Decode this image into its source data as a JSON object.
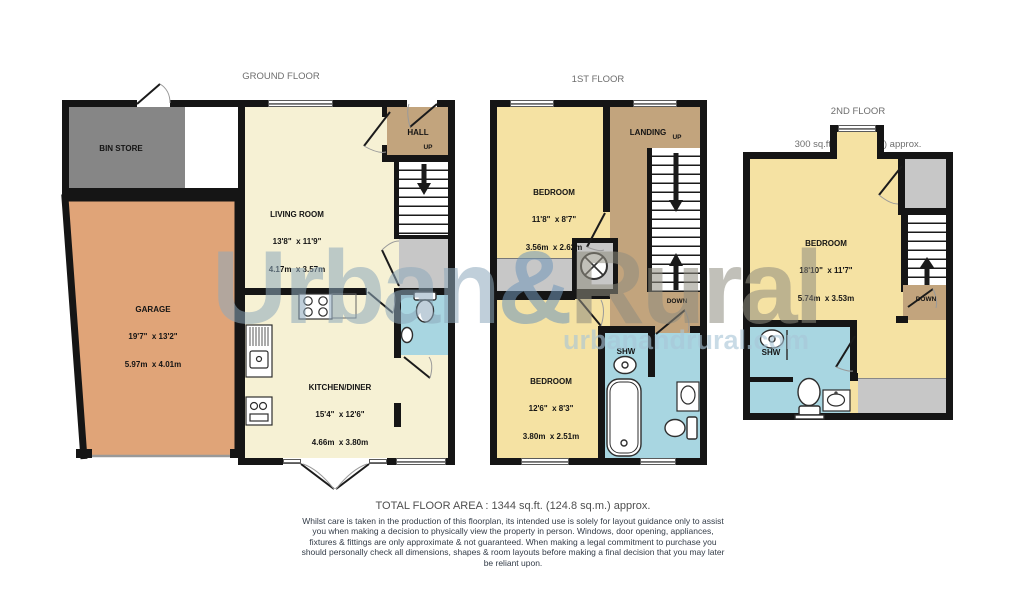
{
  "watermark": {
    "brand_urban": "Urban",
    "brand_amp": "&",
    "brand_rural": "Rural",
    "website": "urbanandrural.com"
  },
  "floors": {
    "ground": {
      "title": "GROUND FLOOR",
      "area": "643 sq.ft. (59.8 sq.m.) approx.",
      "rooms": {
        "bin_store": {
          "name": "BIN STORE"
        },
        "garage": {
          "name": "GARAGE",
          "dims_ft": "19'7\"  x 13'2\"",
          "dims_m": "5.97m  x 4.01m"
        },
        "living": {
          "name": "LIVING ROOM",
          "dims_ft": "13'8\"  x 11'9\"",
          "dims_m": "4.17m  x 3.57m"
        },
        "hall": {
          "name": "HALL",
          "up": "UP"
        },
        "kitchen": {
          "name": "KITCHEN/DINER",
          "dims_ft": "15'4\"  x 12'6\"",
          "dims_m": "4.66m  x 3.80m"
        }
      }
    },
    "first": {
      "title": "1ST FLOOR",
      "area": "401 sq.ft. (37.2 sq.m.) approx.",
      "rooms": {
        "bedroom1": {
          "name": "BEDROOM",
          "dims_ft": "11'8\"  x 8'7\"",
          "dims_m": "3.56m  x 2.62m"
        },
        "landing": {
          "name": "LANDING",
          "up": "UP",
          "down": "DOWN"
        },
        "bedroom2": {
          "name": "BEDROOM",
          "dims_ft": "12'6\"  x 8'3\"",
          "dims_m": "3.80m  x 2.51m"
        },
        "shower": {
          "name": "SHW"
        }
      }
    },
    "second": {
      "title": "2ND FLOOR",
      "area": "300 sq.ft. (27.9 sq.m.) approx.",
      "rooms": {
        "bedroom": {
          "name": "BEDROOM",
          "dims_ft": "18'10\"  x 11'7\"",
          "dims_m": "5.74m  x 3.53m"
        },
        "shower": {
          "name": "SHW"
        },
        "stairs": {
          "down": "DOWN"
        }
      }
    }
  },
  "footer": {
    "total": "TOTAL FLOOR AREA : 1344 sq.ft. (124.8 sq.m.) approx.",
    "disclaimer": "Whilst care is taken in the production of this floorplan, its intended use is solely for layout guidance only to assist you  when making a decision to physically view the property in person. Windows, door opening, appliances, fixtures  & fittings are only approximate & not guaranteed. When making a legal commitment to purchase you should personally check all dimensions, shapes & room layouts before making a final decision that you may later be reliant upon."
  },
  "palette": {
    "wall": "#151515",
    "cream_room": "#f6f1d4",
    "gold_room": "#f5e2a3",
    "tan_hall": "#c2a47d",
    "garage_orange": "#e0a478",
    "bin_gray": "#868686",
    "light_gray": "#c7c7c7",
    "bath_blue": "#a8d6e1",
    "watermark_blue": "#7097ba"
  }
}
